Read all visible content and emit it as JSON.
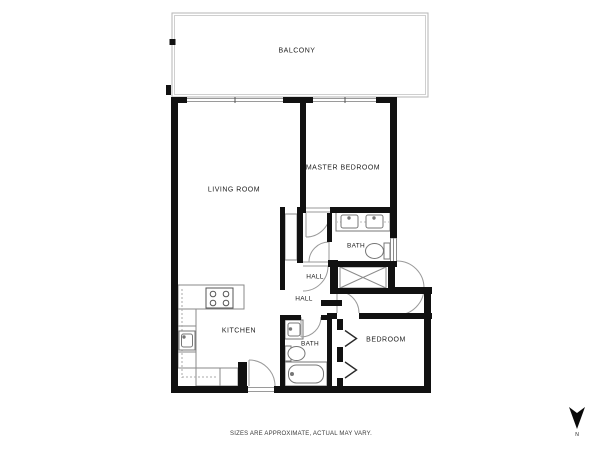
{
  "document": {
    "type": "apartment-floor-plan",
    "background_color": "#ffffff"
  },
  "floor_plan": {
    "rooms": [
      {
        "id": "balcony",
        "label": "BALCONY"
      },
      {
        "id": "living_room",
        "label": "LIVING ROOM"
      },
      {
        "id": "master_bedroom",
        "label": "MASTER BEDROOM"
      },
      {
        "id": "master_bath",
        "label": "BATH"
      },
      {
        "id": "hall_upper",
        "label": "HALL"
      },
      {
        "id": "hall_lower",
        "label": "HALL"
      },
      {
        "id": "kitchen",
        "label": "KITCHEN"
      },
      {
        "id": "bath",
        "label": "BATH"
      },
      {
        "id": "bedroom",
        "label": "BEDROOM"
      }
    ],
    "fixtures": [
      "double-vanity-sinks",
      "toilet",
      "wardrobe-x-closet",
      "entry-door-swing",
      "stove-4-burners",
      "kitchen-sink",
      "kitchen-counters",
      "vanity-sink",
      "toilet",
      "bathtub",
      "bifold-closet-doors",
      "balcony-railing",
      "window-band"
    ],
    "colors": {
      "wall": "#111111",
      "thin_line": "#999999",
      "fixture_line": "#777777",
      "label_text": "#1c1c1c"
    }
  },
  "footer": {
    "disclaimer": "SIZES ARE APPROXIMATE, ACTUAL MAY VARY."
  },
  "compass": {
    "label": "N",
    "direction": "down"
  }
}
